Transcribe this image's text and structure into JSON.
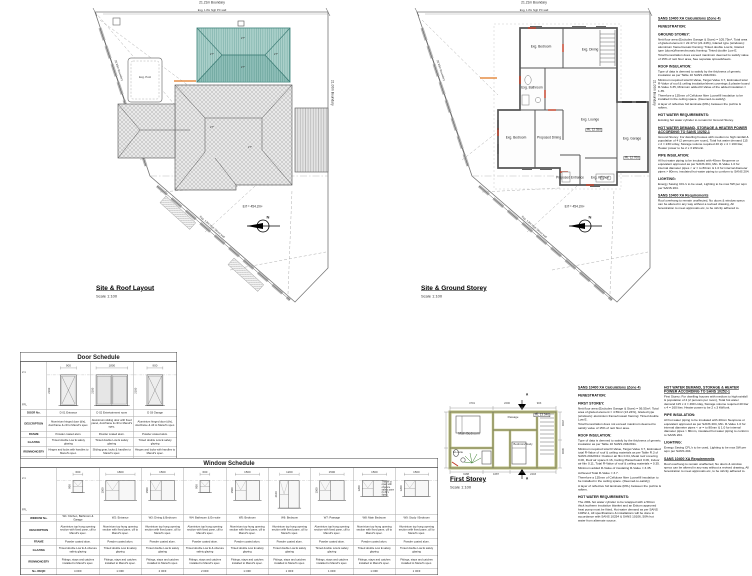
{
  "accent_colors": {
    "new_roof_teal": "#abd0ca",
    "new_roof_dark": "#8fbfb8",
    "wall_olive": "#b9bd7a",
    "markup_red": "#c23b22",
    "markup_orange": "#e07820"
  },
  "left_plan": {
    "title": "Site & Roof Layout",
    "scale": "Scale 1:100",
    "boundary_top": "21.21m Boundary",
    "boundary_right": "21.00m Boundary",
    "boundary_left": "20.95m Boundary",
    "street_wall": "Exg. 1.8m High Street wall",
    "pc_wall": "Exg. 1.8m high PC wall",
    "erf": "Erf = 454.2m²",
    "pool": "Exg. Pool",
    "north": "N",
    "pitch": "27°"
  },
  "right_plan": {
    "title": "Site & Ground Storey",
    "scale": "Scale 1:100",
    "boundary_top": "21.21m Boundary",
    "boundary_right": "21.00m Boundary",
    "boundary_left": "20.95m Boundary",
    "street_wall": "Exg. 1.8m High Street wall",
    "pc_wall": "Exg. 1.8m high PC wall",
    "erf": "Erf = 454.2m²",
    "north": "N",
    "rl_lounge": "RL 12.350",
    "rl_garage": "RL 12.700",
    "rooms": [
      "Exg. Bedroom",
      "Exg. Dining",
      "Exg. Bathroom",
      "Exg. Bedroom",
      "Proposed Dining",
      "Exg. Lounge",
      "Exg. Kitchen",
      "Exg. Garage",
      "Proposed Entrance"
    ]
  },
  "first_storey": {
    "title": "First Storey",
    "scale": "Scale 1:100",
    "rooms": [
      "Main Bedroom",
      "En-suite",
      "Bedroom/Study",
      "Passage"
    ],
    "rl": "RL 13.346",
    "section": "A",
    "dims_top": [
      "4701",
      "2200",
      "903"
    ],
    "dims_bottom": [
      "3188",
      "1687",
      "2403"
    ],
    "dims_right": [
      "2200",
      "3600"
    ]
  },
  "door_schedule": {
    "title": "Door Schedule",
    "levels": [
      "2.1",
      "FFL"
    ],
    "row_labels": [
      "DOOR No.",
      "DESCRIPTION",
      "FRAME",
      "GLAZING",
      "IRONMONGERY",
      "No. REQD"
    ],
    "columns": [
      {
        "no": "D 01 Entrance",
        "desc": "Aluminium hinged door (d/s), doorframe & cill to Manuf's spec.",
        "frame": "Powder coated alum.",
        "glazing": "Tinted double Low E safety glazing",
        "iron": "Hinges and locks with handles to Manuf's spec.",
        "req": "1 OFF",
        "w": "900",
        "h": "2100",
        "type": "hinged"
      },
      {
        "no": "D 02 Entertainment room",
        "desc": "Aluminium sliding door with fixed panel, doorframe & cill to Manuf's spec.",
        "frame": "Powder coated alum.",
        "glazing": "Tinted double Low E safety glazing",
        "iron": "Sliding gear, locks & handles to Manuf's spec.",
        "req": "1 OFF",
        "w": "1800",
        "h": "2100",
        "type": "sliding"
      },
      {
        "no": "D 03 Garage",
        "desc": "Aluminium hinged door (d/s), doorframe & cill to Manuf's spec.",
        "frame": "Powder coated alum.",
        "glazing": "Tinted double Low E safety glazing",
        "iron": "Hinges and locks with handles to Manuf's spec.",
        "req": "1 OFF",
        "w": "900",
        "h": "2100",
        "type": "hinged"
      }
    ]
  },
  "window_schedule": {
    "title": "Window Schedule",
    "levels": [
      "2.1",
      "FFL"
    ],
    "row_labels": [
      "WINDOW No.",
      "DESCRIPTION",
      "FRAME",
      "GLAZING",
      "IRONMONGERY",
      "No. REQD"
    ],
    "columns": [
      {
        "no": "W1: Kitchen, Bathroom & Garage",
        "desc": "Aluminium top hung opening section with fixed pane, cill to Manuf's spec.",
        "frame": "Powder coated alum.",
        "glazing": "Tinted double Low E & obscure safety glazing",
        "iron": "Fittings, stays and catches installed to Manuf's spec.",
        "req": "4 OFF",
        "w": "600",
        "h": "900"
      },
      {
        "no": "W2: Entrance",
        "desc": "Aluminium top hung opening section with fixed pane, cill to Manuf's spec.",
        "frame": "Powder coated alum.",
        "glazing": "Tinted double Low E safety glazing",
        "iron": "Fittings, stays and catches installed to Manuf's spec.",
        "req": "1 OFF",
        "w": "1800",
        "h": "1500"
      },
      {
        "no": "W3: Dining & Bedroom",
        "desc": "Aluminium top hung opening section with fixed pane, cill to Manuf's spec.",
        "frame": "Powder coated alum.",
        "glazing": "Tinted double Low E safety glazing",
        "iron": "Fittings, stays and catches installed to Manuf's spec.",
        "req": "2 OFF",
        "w": "1500",
        "h": "1500"
      },
      {
        "no": "W4: Bathroom & En-suite",
        "desc": "Aluminium top hung opening section with fixed pane, cill to Manuf's spec.",
        "frame": "Powder coated alum.",
        "glazing": "Tinted double Low E & obscure safety glazing",
        "iron": "Fittings, stays and catches installed to Manuf's spec.",
        "req": "2 OFF",
        "w": "600",
        "h": "900"
      },
      {
        "no": "W5: Bedroom",
        "desc": "Aluminium top hung opening section with fixed pane, cill to Manuf's spec.",
        "frame": "Powder coated alum.",
        "glazing": "Tinted double Low E safety glazing",
        "iron": "Fittings, stays and catches installed to Manuf's spec.",
        "req": "1 OFF",
        "w": "1500",
        "h": "1500"
      },
      {
        "no": "W6: Bedroom",
        "desc": "Aluminium top hung opening section with fixed pane, cill to Manuf's spec.",
        "frame": "Powder coated alum.",
        "glazing": "Tinted double Low E safety glazing",
        "iron": "Fittings, stays and catches installed to Manuf's spec.",
        "req": "1 OFF",
        "w": "1200",
        "h": "2100"
      },
      {
        "no": "W7: Passage",
        "desc": "Aluminium top hung opening section with fixed pane, cill to Manuf's spec.",
        "frame": "Powder coated alum.",
        "glazing": "Tinted double Low E safety glazing",
        "iron": "Fittings, stays and catches installed to Manuf's spec.",
        "req": "1 OFF",
        "w": "1500",
        "h": "1500"
      },
      {
        "no": "W8: Main Bedroom",
        "desc": "Aluminium top hung opening section with fixed pane, cill to Manuf's spec.",
        "frame": "Powder coated alum.",
        "glazing": "Tinted double Low E safety glazing",
        "iron": "Fittings, stays and catches installed to Manuf's spec.",
        "req": "1 OFF",
        "w": "1500",
        "h": "1200",
        "note": "This W to open with obscure safety pane (to M's spec)"
      },
      {
        "no": "W9: Study / Bedroom",
        "desc": "Aluminium top hung opening section with fixed pane, cill to Manuf's spec.",
        "frame": "Powder coated alum.",
        "glazing": "Tinted double Low E safety glazing",
        "iron": "Fittings, stays and catches installed to Manuf's spec.",
        "req": "1 OFF",
        "w": "1500",
        "h": "1200"
      }
    ]
  },
  "calc_top": {
    "sections": [
      {
        "t": "h",
        "u": true,
        "x": "SANS 10400 XA Calculations (Zone 4)"
      },
      {
        "t": "h",
        "x": "FENESTRATION:"
      },
      {
        "t": "h",
        "x": "GROUND STOREY:"
      },
      {
        "t": "b",
        "x": "Nett floor area (Excludes Garage & Store) = 105.75m², Total area of glazed element = 22.47m² (21.24%), Glazed type (windows): aluminium frame/mosaic framing: Tinted double Low E, Glazed type (doors)/frames/mosaic framing: Tinted double Low E."
      },
      {
        "t": "b",
        "x": "Total Fenestration does exceed maximum deemed to satisfy value of 15% of nett floor area, See separate spreadsheets."
      },
      {
        "t": "h",
        "x": "ROOF INSULATION:"
      },
      {
        "t": "b",
        "x": "Type of data is deemed to satisfy by the thickness of generic insulation as per Table 10 SANS 204/2011."
      },
      {
        "t": "b",
        "x": "Minimum required total R-Value, Target Value 3.7, Estimated total R-Value of roof & ceiling insulation/sheet coverings & plaster board R-Value 3.35, Minimum added R-Value of the added insulation = 1.35."
      },
      {
        "t": "b",
        "x": "Therefore a 135mm of Cellulose fibre Loosefill insulation to be installed in the ceiling space. (Deemed-to-satisfy)"
      },
      {
        "t": "b",
        "x": "A layer of reflective foil laminate (RFL) between the purlins & rafters."
      },
      {
        "t": "h",
        "x": "HOT WATER REQUIREMENTS:"
      },
      {
        "t": "b",
        "x": "Existing hot water cylinder to remain for Ground Storey."
      },
      {
        "t": "h",
        "u": true,
        "x": "HOT WATER DEMAND, STORAGE & HEATER POWER ACCORDING TO SANS 10252-1"
      },
      {
        "t": "b",
        "x": "Ground Storey: For dwelling houses with medium to high rainfall & population of 4 (2 persons per room), Total hot water demand 115 x 2 = 230 L/day, Storage volume required 40 l/p x 4 = 160 liter, Heater power to be 2 x 3 kW/unit."
      },
      {
        "t": "h",
        "x": "PIPE INSULATION:"
      },
      {
        "t": "b",
        "x": "All hot water piping to be insulated with 40mm Neoprene or equivalent approved as per SANS 204, Min. R-Value 1.0 for internal diameter pipes < or = to 80mm & 1.0 for internal diameter pipes > 80mm, insulated hot water piping to conform to SANS 204."
      },
      {
        "t": "h",
        "x": "LIGHTING:"
      },
      {
        "t": "b",
        "x": "Energy Saving CFL's to be used, Lighting to be max 5W per sqm per SANS 204."
      },
      {
        "t": "h",
        "u": true,
        "x": "SANS 10400 XA Requirements"
      },
      {
        "t": "b",
        "x": "Roof overhang to remain unaffected, No doors & window specs can be altered in any way without a revised drawing, All fenestration to meet approvals etc, to be strictly adhered to."
      }
    ]
  },
  "calc_bl": {
    "sections": [
      {
        "t": "h",
        "u": true,
        "x": "SANS 10400 XA Calculations (Zone 4)"
      },
      {
        "t": "h",
        "x": "FENESTRATION:"
      },
      {
        "t": "h",
        "x": "FIRST STOREY:"
      },
      {
        "t": "b",
        "x": "Nett floor area (Excludes Garage & Store) = 56.55m², Total area of glazed element = 4.59m² (13.24%), Glazed type (windows): aluminium frame/mosaic framing: Tinted double Low E."
      },
      {
        "t": "b",
        "x": "Total Fenestration does not exceed maximum deemed to satisfy value of 15% of nett floor area."
      },
      {
        "t": "h",
        "x": "ROOF INSULATION:"
      },
      {
        "t": "b",
        "x": "Type of data is deemed to satisfy by the thickness of generic insulation as per Table 10 SANS 204/2011."
      },
      {
        "t": "b",
        "x": "Minimum required total R-Value, Target Value 3.7, Estimated total R-Value of roof & ceiling materials as per Table R.3 of SANS 204/2011: Outdoor air film 0.04, Metal roof covering 0.00, Roof air space 0.16, Ceiling Plasterboard 0.06, Indoor air film 0.11, Total R-Value of roof & ceiling materials = 0.35."
      },
      {
        "t": "b",
        "x": "Minimum added R-Value of insulating R-Value = 3.35."
      },
      {
        "t": "b",
        "x": "Achieved Total R-Value = 3.7."
      },
      {
        "t": "b",
        "x": "Therefore a 135mm of Cellulose fibre Loosefill insulation to be installed in the ceiling space. (Deemed-to-satisfy)"
      },
      {
        "t": "b",
        "x": "A layer of reflective foil laminate (RFL) between the purlins & rafters."
      },
      {
        "t": "h",
        "x": "HOT WATER REQUIREMENTS:"
      },
      {
        "t": "b",
        "x": "The 200L hot water cylinder to be wrapped with a 50mm thick isotherm insulation blanket and an Eskom approved heat pump must be fitted, Hot water demand as per SANS 10252-1, All specifications & installations will be done in accordance with SANS 10254 & SANS 10106, 50% hot water from alternate source."
      }
    ]
  },
  "calc_br": {
    "sections": [
      {
        "t": "h",
        "u": true,
        "x": "HOT WATER DEMAND, STORAGE & HEATER POWER ACCORDING TO SANS 10252-1"
      },
      {
        "t": "b",
        "x": "First Storey: For dwelling houses with medium to high rainfall & population of 4 (2 persons per room), Total hot water demand 115 x 4 = 460 L/day, Storage volume required 40 liter x 4 = 160 liter, Heater power to be 2 x 3 kW/unit."
      },
      {
        "t": "h",
        "x": "PIPE INSULATION:"
      },
      {
        "t": "b",
        "x": "All hot water piping to be insulated with 40mm Neoprene or equivalent approved as per SANS 204, Min. R-Value 1.0 for internal diameter pipes < or = to 80mm & 1.0 for internal diameter pipes > 80mm, insulated hot water piping to conform to SANS 204."
      },
      {
        "t": "h",
        "x": "LIGHTING:"
      },
      {
        "t": "b",
        "x": "Energy Saving CFL's to be used, Lighting to be max 5W per sqm per SANS 204."
      },
      {
        "t": "h",
        "u": true,
        "x": "SANS 10400 XA Requirements"
      },
      {
        "t": "b",
        "x": "Roof overhang to remain unaffected, No doors & window specs can be altered in any way without a revised drawing, All fenestration to meet approvals etc, to be strictly adhered to."
      }
    ]
  }
}
